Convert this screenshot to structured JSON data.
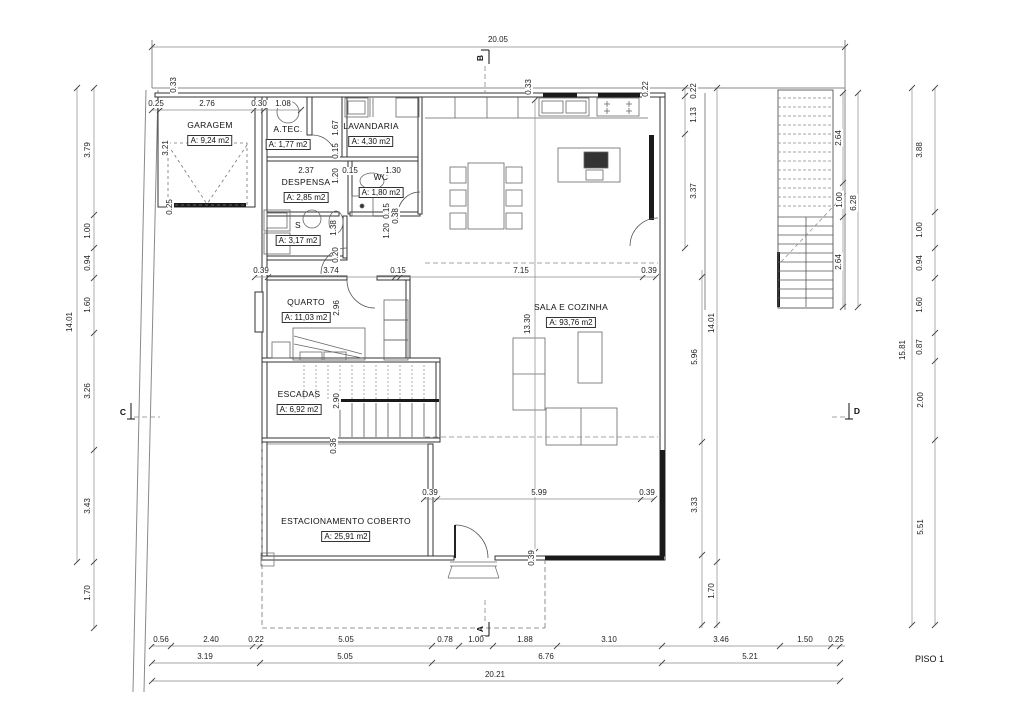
{
  "title": "PISO 1",
  "rooms": [
    {
      "id": "garagem",
      "name": "GARAGEM",
      "area": "A: 9,24 m2",
      "x": 210,
      "y": 120
    },
    {
      "id": "atec",
      "name": "A.TEC.",
      "area": "A: 1,77 m2",
      "x": 288,
      "y": 124
    },
    {
      "id": "lavandaria",
      "name": "LAVANDARIA",
      "area": "A: 4,30 m2",
      "x": 371,
      "y": 121
    },
    {
      "id": "despensa",
      "name": "DESPENSA",
      "area": "A: 2,85 m2",
      "x": 306,
      "y": 177
    },
    {
      "id": "wc",
      "name": "WC",
      "area": "A: 1,80 m2",
      "x": 381,
      "y": 172
    },
    {
      "id": "s",
      "name": "S",
      "area": "A: 3,17 m2",
      "x": 298,
      "y": 220
    },
    {
      "id": "quarto",
      "name": "QUARTO",
      "area": "A: 11,03 m2",
      "x": 306,
      "y": 297
    },
    {
      "id": "escadas",
      "name": "ESCADAS",
      "area": "A: 6,92 m2",
      "x": 299,
      "y": 389
    },
    {
      "id": "sala-cozinha",
      "name": "SALA E COZINHA",
      "area": "A: 93,76 m2",
      "x": 571,
      "y": 302
    },
    {
      "id": "estacionamento",
      "name": "ESTACIONAMENTO COBERTO",
      "area": "A: 25,91 m2",
      "x": 346,
      "y": 516
    }
  ],
  "dims_h": [
    [
      "20.05",
      498,
      40
    ],
    [
      "0.25",
      156,
      104
    ],
    [
      "2.76",
      207,
      104
    ],
    [
      "0.30",
      259,
      104
    ],
    [
      "1.08",
      283,
      104
    ],
    [
      "2.37",
      306,
      171
    ],
    [
      "0.15",
      350,
      171
    ],
    [
      "1.30",
      393,
      171
    ],
    [
      "0.39",
      261,
      271
    ],
    [
      "3.74",
      331,
      271
    ],
    [
      "0.15",
      398,
      271
    ],
    [
      "7.15",
      521,
      271
    ],
    [
      "0.39",
      649,
      271
    ],
    [
      "0.39",
      430,
      493
    ],
    [
      "5.99",
      539,
      493
    ],
    [
      "0.39",
      647,
      493
    ],
    [
      "0.56",
      161,
      640
    ],
    [
      "2.40",
      211,
      640
    ],
    [
      "0.22",
      256,
      640
    ],
    [
      "5.05",
      346,
      640
    ],
    [
      "0.78",
      445,
      640
    ],
    [
      "1.00",
      476,
      640
    ],
    [
      "1.88",
      525,
      640
    ],
    [
      "3.10",
      609,
      640
    ],
    [
      "3.46",
      721,
      640
    ],
    [
      "1.50",
      805,
      640
    ],
    [
      "0.25",
      836,
      640
    ],
    [
      "3.19",
      205,
      657
    ],
    [
      "5.05",
      345,
      657
    ],
    [
      "6.76",
      546,
      657
    ],
    [
      "5.21",
      750,
      657
    ],
    [
      "20.21",
      495,
      675
    ]
  ],
  "dims_v": [
    [
      "0.33",
      174,
      85
    ],
    [
      "3.21",
      166,
      148
    ],
    [
      "0.25",
      170,
      207
    ],
    [
      "0.33",
      529,
      87
    ],
    [
      "0.22",
      646,
      89
    ],
    [
      "1.67",
      336,
      128
    ],
    [
      "0.15",
      336,
      151
    ],
    [
      "1.20",
      336,
      176
    ],
    [
      "1.38",
      334,
      228
    ],
    [
      "0.20",
      336,
      255
    ],
    [
      "0.15",
      387,
      211
    ],
    [
      "1.20",
      387,
      231
    ],
    [
      "0.38",
      396,
      216
    ],
    [
      "2.96",
      337,
      308
    ],
    [
      "2.90",
      337,
      401
    ],
    [
      "0.36",
      334,
      446
    ],
    [
      "13.30",
      528,
      324
    ],
    [
      "0.39",
      532,
      558
    ],
    [
      "0.22",
      694,
      91
    ],
    [
      "1.13",
      694,
      115
    ],
    [
      "3.37",
      694,
      191
    ],
    [
      "5.96",
      695,
      357
    ],
    [
      "3.33",
      695,
      505
    ],
    [
      "14.01",
      712,
      323
    ],
    [
      "1.70",
      712,
      591
    ],
    [
      "2.64",
      839,
      138
    ],
    [
      "1.00",
      840,
      200
    ],
    [
      "2.64",
      839,
      262
    ],
    [
      "6.28",
      854,
      203
    ],
    [
      "14.01",
      70,
      322
    ],
    [
      "3.79",
      88,
      150
    ],
    [
      "1.00",
      88,
      231
    ],
    [
      "0.94",
      88,
      263
    ],
    [
      "1.60",
      88,
      305
    ],
    [
      "3.26",
      88,
      391
    ],
    [
      "3.43",
      88,
      506
    ],
    [
      "1.70",
      88,
      593
    ],
    [
      "15.81",
      903,
      350
    ],
    [
      "3.88",
      920,
      150
    ],
    [
      "1.00",
      920,
      230
    ],
    [
      "0.94",
      920,
      263
    ],
    [
      "1.60",
      920,
      305
    ],
    [
      "0.87",
      920,
      347
    ],
    [
      "2.00",
      921,
      400
    ],
    [
      "5.51",
      921,
      527
    ]
  ],
  "sections": [
    {
      "label": "B",
      "x": 480,
      "y": 58,
      "rot": true
    },
    {
      "label": "A",
      "x": 480,
      "y": 629,
      "rot": true
    },
    {
      "label": "C",
      "x": 123,
      "y": 412,
      "rot": false
    },
    {
      "label": "D",
      "x": 857,
      "y": 411,
      "rot": false
    }
  ],
  "dim_lines": [
    {
      "o": "h",
      "c": 47,
      "a": 152,
      "b": 845,
      "t": [
        152,
        845
      ]
    },
    {
      "o": "h",
      "c": 110,
      "a": 152,
      "b": 301,
      "t": [
        152,
        160,
        254,
        264,
        301
      ]
    },
    {
      "o": "h",
      "c": 277,
      "a": 255,
      "b": 656,
      "t": [
        255,
        268,
        395,
        400,
        643,
        656
      ]
    },
    {
      "o": "h",
      "c": 499,
      "a": 424,
      "b": 654,
      "t": [
        424,
        437,
        641,
        654
      ]
    },
    {
      "o": "h",
      "c": 646,
      "a": 152,
      "b": 845,
      "t": [
        152,
        171,
        253,
        260,
        432,
        459,
        493,
        557,
        662,
        780,
        831,
        840
      ]
    },
    {
      "o": "h",
      "c": 663,
      "a": 152,
      "b": 840,
      "t": [
        152,
        260,
        432,
        662,
        840
      ]
    },
    {
      "o": "h",
      "c": 681,
      "a": 152,
      "b": 840,
      "t": [
        152,
        840
      ]
    },
    {
      "o": "v",
      "c": 77,
      "a": 88,
      "b": 562,
      "t": [
        88,
        562
      ]
    },
    {
      "o": "v",
      "c": 94,
      "a": 88,
      "b": 628,
      "t": [
        88,
        215,
        248,
        278,
        333,
        450,
        562,
        628
      ]
    },
    {
      "o": "v",
      "c": 912,
      "a": 88,
      "b": 625,
      "t": [
        88,
        625
      ]
    },
    {
      "o": "v",
      "c": 935,
      "a": 88,
      "b": 625,
      "t": [
        88,
        212,
        248,
        278,
        333,
        361,
        440,
        625
      ]
    },
    {
      "o": "v",
      "c": 685,
      "a": 88,
      "b": 248,
      "t": [
        88,
        96,
        134,
        248
      ]
    },
    {
      "o": "v",
      "c": 702,
      "a": 270,
      "b": 628,
      "t": [
        277,
        442,
        555,
        625
      ]
    },
    {
      "o": "v",
      "c": 717,
      "a": 88,
      "b": 628,
      "t": [
        88,
        562,
        625
      ]
    },
    {
      "o": "v",
      "c": 843,
      "a": 93,
      "b": 307,
      "t": [
        93,
        183,
        217,
        307
      ]
    },
    {
      "o": "v",
      "c": 858,
      "a": 93,
      "b": 307,
      "t": [
        93,
        307
      ]
    },
    {
      "o": "v",
      "c": 535,
      "a": 100,
      "b": 552,
      "t": [
        100,
        552
      ]
    }
  ]
}
